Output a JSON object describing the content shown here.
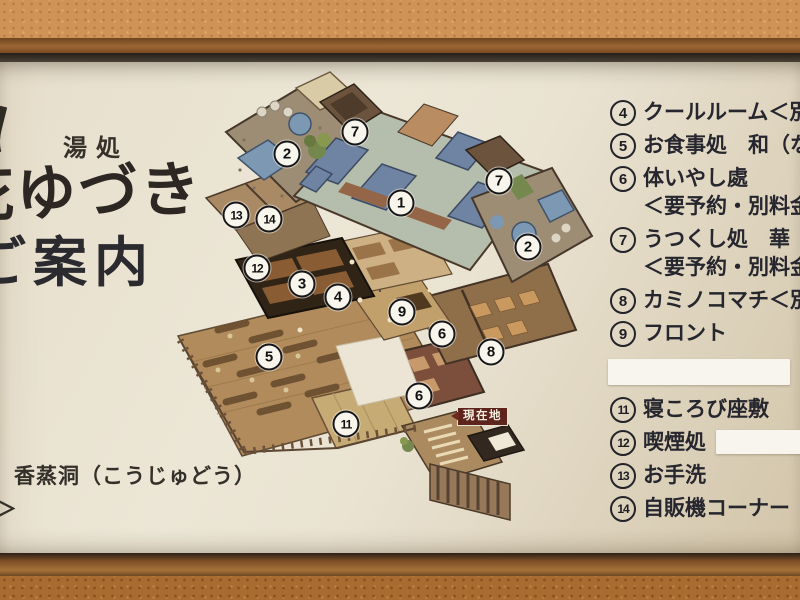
{
  "sign": {
    "venue_type": "湯処",
    "venue_name": "花ゆづき",
    "title": "ご案内",
    "footnote": "香蒸洞（こうじゅどう）",
    "footnote_fragment": "＞"
  },
  "legend": {
    "items": [
      {
        "num": "4",
        "lines": [
          "クールルーム＜別"
        ]
      },
      {
        "num": "5",
        "lines": [
          "お食事処　和（な"
        ]
      },
      {
        "num": "6",
        "lines": [
          "体いやし處",
          "＜要予約・別料金＞"
        ]
      },
      {
        "num": "7",
        "lines": [
          "うつくし処　華（は",
          "＜要予約・別料金＞"
        ]
      },
      {
        "num": "8",
        "lines": [
          "カミノコマチ＜別料"
        ]
      },
      {
        "num": "9",
        "lines": [
          "フロント"
        ]
      },
      {
        "type": "sticker"
      },
      {
        "num": "11",
        "lines": [
          "寝ころび座敷"
        ]
      },
      {
        "num": "12",
        "lines": [
          "喫煙処"
        ],
        "sticker_after": true
      },
      {
        "num": "13",
        "lines": [
          "お手洗"
        ]
      },
      {
        "num": "14",
        "lines": [
          "自販機コーナー"
        ]
      }
    ]
  },
  "map": {
    "current_location": "現在地",
    "markers": [
      {
        "num": "2",
        "x": 287,
        "y": 154
      },
      {
        "num": "7",
        "x": 355,
        "y": 132
      },
      {
        "num": "1",
        "x": 401,
        "y": 203
      },
      {
        "num": "7",
        "x": 499,
        "y": 181
      },
      {
        "num": "2",
        "x": 528,
        "y": 247
      },
      {
        "num": "13",
        "x": 236,
        "y": 215
      },
      {
        "num": "14",
        "x": 269,
        "y": 219
      },
      {
        "num": "12",
        "x": 257,
        "y": 268
      },
      {
        "num": "3",
        "x": 302,
        "y": 284
      },
      {
        "num": "4",
        "x": 338,
        "y": 297
      },
      {
        "num": "9",
        "x": 402,
        "y": 312
      },
      {
        "num": "6",
        "x": 442,
        "y": 334
      },
      {
        "num": "8",
        "x": 491,
        "y": 352
      },
      {
        "num": "5",
        "x": 269,
        "y": 357
      },
      {
        "num": "6",
        "x": 419,
        "y": 396
      },
      {
        "num": "11",
        "x": 346,
        "y": 424
      }
    ]
  },
  "colors": {
    "sign_cream": "#e9e1cf",
    "badge_red": "#5d241c",
    "pool_blue": "#7c98b2",
    "wood_brown": "#b18b5b",
    "wall_stucco": "#cf9357"
  }
}
